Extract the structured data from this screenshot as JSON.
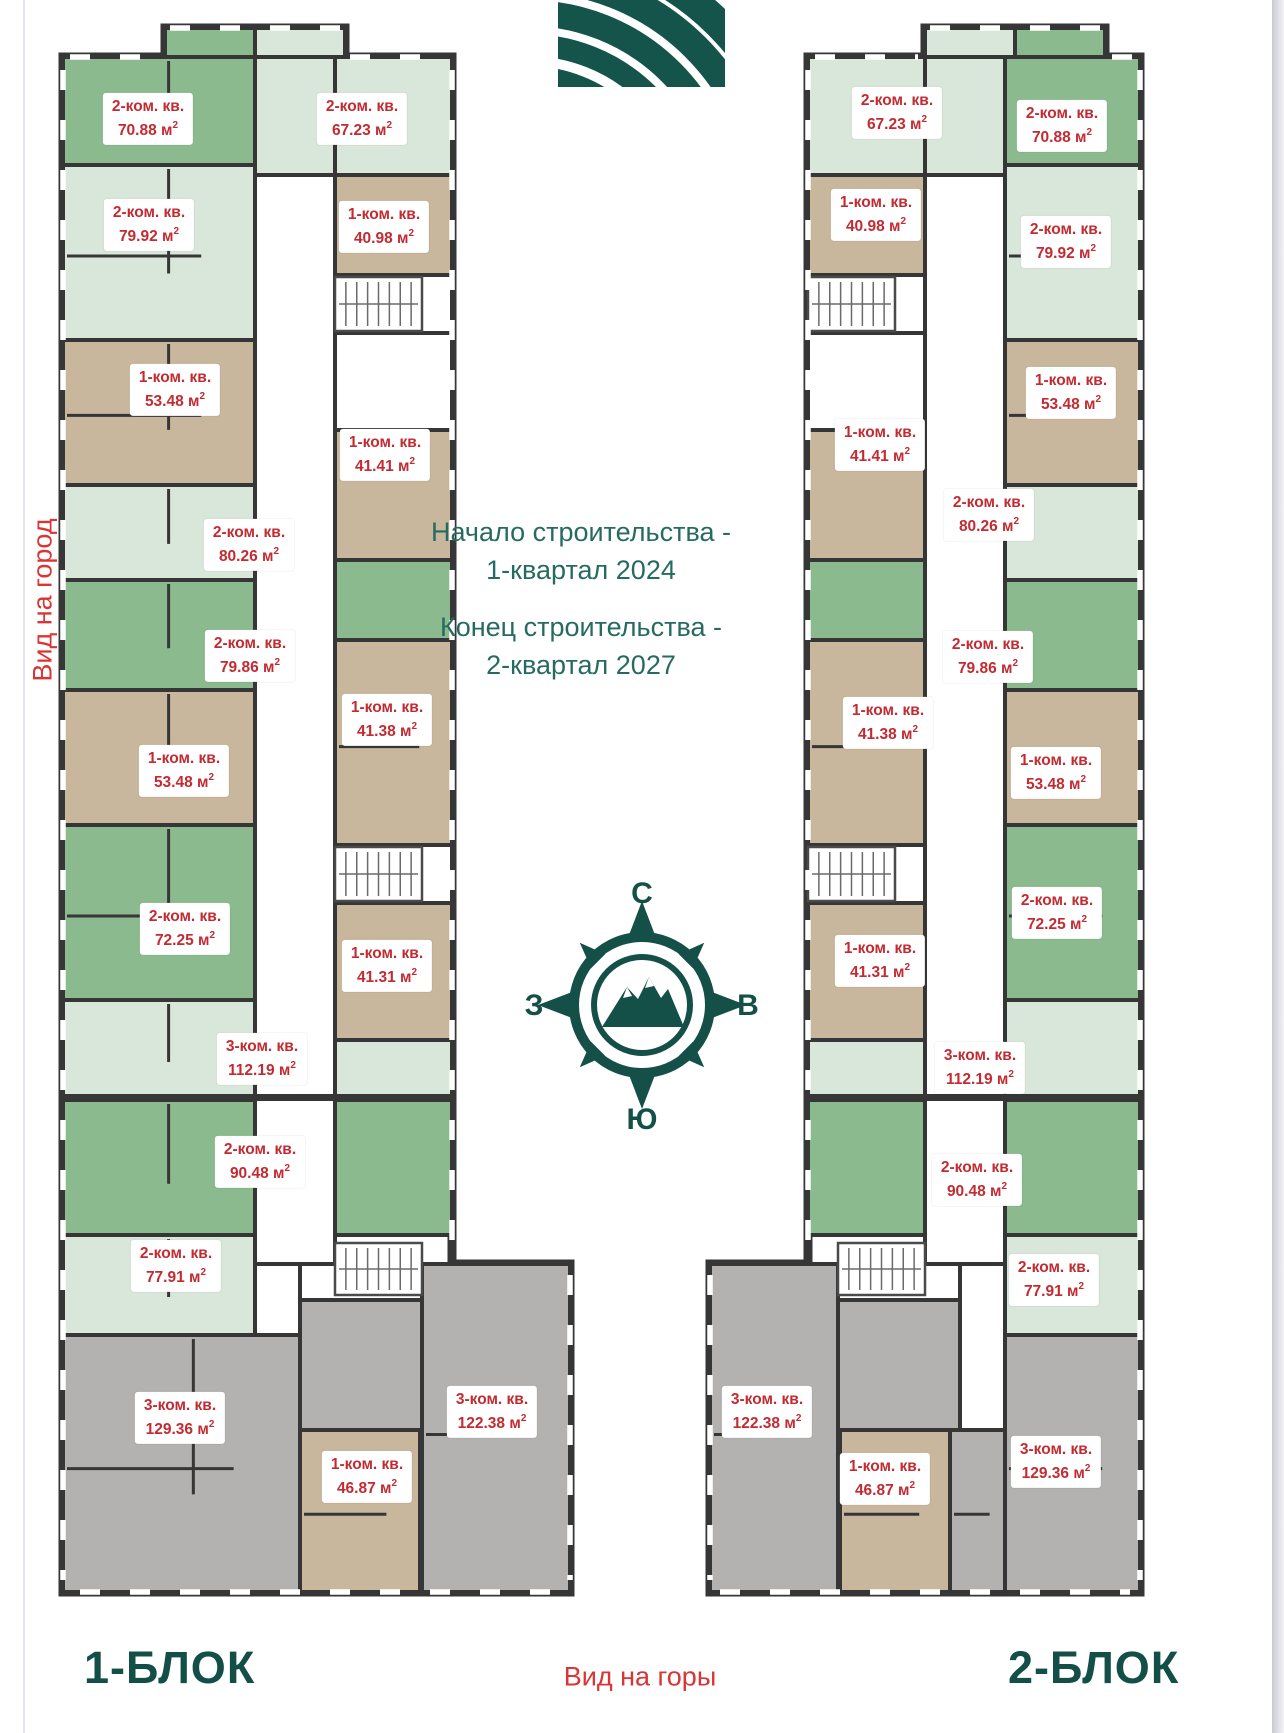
{
  "page": {
    "background": "#ffffff"
  },
  "notes": {
    "start_line1": "Начало строительства -",
    "start_line2": "1-квартал 2024",
    "end_line1": "Конец строительства -",
    "end_line2": "2-квартал 2027"
  },
  "views": {
    "left": "Вид на город",
    "bottom": "Вид на горы"
  },
  "compass": {
    "north": "С",
    "south": "Ю",
    "west": "З",
    "east": "В"
  },
  "colors": {
    "wall": "#363636",
    "room_green": "#8bba8f",
    "room_pale": "#d9e6da",
    "room_tan": "#c8b79c",
    "room_gray": "#b4b2b0",
    "room_white": "#ffffff",
    "label_text": "#c22b31",
    "accent_teal": "#276b60",
    "dark_teal": "#155048",
    "view_red": "#d93535"
  },
  "blocks": [
    {
      "title": "1-БЛОК",
      "apartments": [
        {
          "rooms": "2-ком. кв.",
          "area_label": "70.88 м²",
          "x": 148,
          "y": 119
        },
        {
          "rooms": "2-ком. кв.",
          "area_label": "67.23 м²",
          "x": 362,
          "y": 119
        },
        {
          "rooms": "2-ком. кв.",
          "area_label": "79.92 м²",
          "x": 149,
          "y": 225
        },
        {
          "rooms": "1-ком. кв.",
          "area_label": "40.98 м²",
          "x": 384,
          "y": 227
        },
        {
          "rooms": "1-ком. кв.",
          "area_label": "53.48 м²",
          "x": 175,
          "y": 390
        },
        {
          "rooms": "1-ком. кв.",
          "area_label": "41.41 м²",
          "x": 385,
          "y": 455
        },
        {
          "rooms": "2-ком. кв.",
          "area_label": "80.26 м²",
          "x": 249,
          "y": 545
        },
        {
          "rooms": "2-ком. кв.",
          "area_label": "79.86 м²",
          "x": 250,
          "y": 656
        },
        {
          "rooms": "1-ком. кв.",
          "area_label": "41.38 м²",
          "x": 387,
          "y": 720
        },
        {
          "rooms": "1-ком. кв.",
          "area_label": "53.48 м²",
          "x": 184,
          "y": 771
        },
        {
          "rooms": "2-ком. кв.",
          "area_label": "72.25 м²",
          "x": 185,
          "y": 929
        },
        {
          "rooms": "1-ком. кв.",
          "area_label": "41.31 м²",
          "x": 387,
          "y": 966
        },
        {
          "rooms": "3-ком. кв.",
          "area_label": "112.19 м²",
          "x": 262,
          "y": 1059
        },
        {
          "rooms": "2-ком. кв.",
          "area_label": "90.48 м²",
          "x": 260,
          "y": 1162
        },
        {
          "rooms": "2-ком. кв.",
          "area_label": "77.91 м²",
          "x": 176,
          "y": 1266
        },
        {
          "rooms": "3-ком. кв.",
          "area_label": "129.36 м²",
          "x": 180,
          "y": 1418
        },
        {
          "rooms": "3-ком. кв.",
          "area_label": "122.38 м²",
          "x": 492,
          "y": 1412
        },
        {
          "rooms": "1-ком. кв.",
          "area_label": "46.87 м²",
          "x": 367,
          "y": 1477
        }
      ]
    },
    {
      "title": "2-БЛОК",
      "apartments": [
        {
          "rooms": "2-ком. кв.",
          "area_label": "67.23 м²",
          "x": 897,
          "y": 113
        },
        {
          "rooms": "2-ком. кв.",
          "area_label": "70.88 м²",
          "x": 1062,
          "y": 126
        },
        {
          "rooms": "1-ком. кв.",
          "area_label": "40.98 м²",
          "x": 876,
          "y": 215
        },
        {
          "rooms": "2-ком. кв.",
          "area_label": "79.92 м²",
          "x": 1066,
          "y": 242
        },
        {
          "rooms": "1-ком. кв.",
          "area_label": "53.48 м²",
          "x": 1071,
          "y": 393
        },
        {
          "rooms": "1-ком. кв.",
          "area_label": "41.41 м²",
          "x": 880,
          "y": 445
        },
        {
          "rooms": "2-ком. кв.",
          "area_label": "80.26 м²",
          "x": 989,
          "y": 515
        },
        {
          "rooms": "2-ком. кв.",
          "area_label": "79.86 м²",
          "x": 988,
          "y": 657
        },
        {
          "rooms": "1-ком. кв.",
          "area_label": "41.38 м²",
          "x": 888,
          "y": 723
        },
        {
          "rooms": "1-ком. кв.",
          "area_label": "53.48 м²",
          "x": 1056,
          "y": 773
        },
        {
          "rooms": "2-ком. кв.",
          "area_label": "72.25 м²",
          "x": 1057,
          "y": 913
        },
        {
          "rooms": "1-ком. кв.",
          "area_label": "41.31 м²",
          "x": 880,
          "y": 961
        },
        {
          "rooms": "3-ком. кв.",
          "area_label": "112.19 м²",
          "x": 980,
          "y": 1068
        },
        {
          "rooms": "2-ком. кв.",
          "area_label": "90.48 м²",
          "x": 977,
          "y": 1180
        },
        {
          "rooms": "2-ком. кв.",
          "area_label": "77.91 м²",
          "x": 1054,
          "y": 1280
        },
        {
          "rooms": "3-ком. кв.",
          "area_label": "122.38 м²",
          "x": 767,
          "y": 1412
        },
        {
          "rooms": "1-ком. кв.",
          "area_label": "46.87 м²",
          "x": 885,
          "y": 1479
        },
        {
          "rooms": "3-ком. кв.",
          "area_label": "129.36 м²",
          "x": 1056,
          "y": 1462
        }
      ]
    }
  ]
}
